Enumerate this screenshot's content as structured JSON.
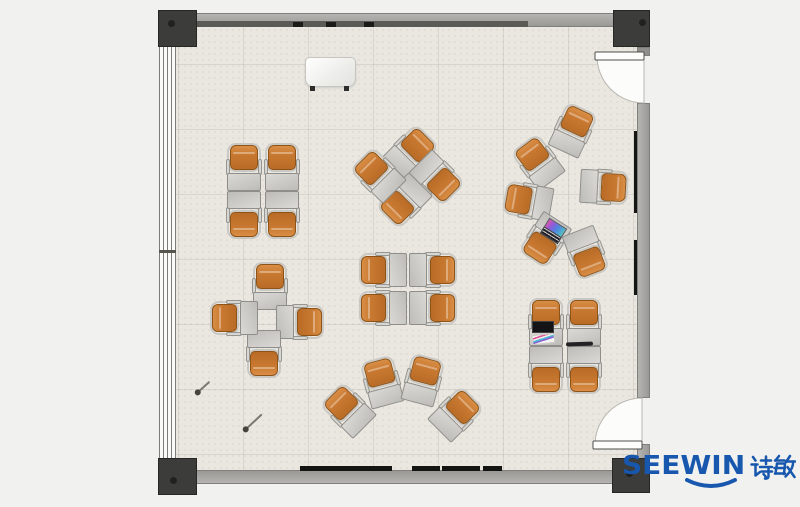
{
  "brand": {
    "name": "SEEWIN",
    "chinese": "诗敏",
    "color": "#1857ae"
  },
  "palette": {
    "floor": "#eae7e0",
    "wall": "#a6a5a1",
    "column": "#3c3c3a",
    "chair": "#c4752e",
    "desk": "#cbcac6",
    "frame": "#c9c8c4",
    "door_swing": "#fcfcfa"
  },
  "room": {
    "columns": [
      {
        "x": 158,
        "y": 10,
        "w": 39,
        "h": 37,
        "dx": 9,
        "dy": 9
      },
      {
        "x": 613,
        "y": 10,
        "w": 37,
        "h": 37,
        "dx": 25,
        "dy": 8
      },
      {
        "x": 158,
        "y": 458,
        "w": 39,
        "h": 37,
        "dx": 11,
        "dy": 18
      },
      {
        "x": 612,
        "y": 458,
        "w": 38,
        "h": 35,
        "dx": 13,
        "dy": 11
      }
    ],
    "doors": [
      {
        "id": "door-top-right",
        "leaf": [
          595,
          52,
          49,
          8
        ],
        "region": "M644 56 L597 56 A47 47 0 0 0 644 103 Z"
      },
      {
        "id": "door-bottom-right",
        "leaf": [
          593,
          441,
          49,
          8
        ],
        "region": "M642 445 L595 445 A47 47 0 0 1 642 398 Z"
      }
    ],
    "wall_ticks_x": [
      293,
      326,
      364
    ],
    "rails": [
      [
        300,
        92
      ],
      [
        412,
        28
      ],
      [
        442,
        38
      ],
      [
        483,
        19
      ]
    ],
    "right_wall_strips": [
      [
        131,
        82
      ],
      [
        240,
        55
      ]
    ]
  },
  "furniture": {
    "unit_style": {
      "chair": "#c4752e",
      "chair_border": "#8d5317",
      "desk": "#cbcac6",
      "desk_border": "#8f8e8a",
      "frame": "#c9c8c4"
    },
    "clusters": [
      {
        "id": "front-left-grid",
        "units": [
          {
            "x": 244,
            "y": 167,
            "r": 0
          },
          {
            "x": 282,
            "y": 167,
            "r": 0
          },
          {
            "x": 244,
            "y": 215,
            "r": 180
          },
          {
            "x": 282,
            "y": 215,
            "r": 180
          }
        ]
      },
      {
        "id": "front-center-diamond",
        "units": [
          {
            "x": 411,
            "y": 152,
            "r": 45
          },
          {
            "x": 437,
            "y": 178,
            "r": 135
          },
          {
            "x": 404,
            "y": 201,
            "r": 225
          },
          {
            "x": 378,
            "y": 175,
            "r": 315
          }
        ]
      },
      {
        "id": "right-circle",
        "units": [
          {
            "x": 573,
            "y": 130,
            "r": 25
          },
          {
            "x": 538,
            "y": 162,
            "r": 323
          },
          {
            "x": 528,
            "y": 201,
            "r": 280
          },
          {
            "x": 604,
            "y": 187,
            "r": 93
          },
          {
            "x": 545,
            "y": 240,
            "r": 213
          },
          {
            "x": 586,
            "y": 253,
            "r": 159
          }
        ]
      },
      {
        "id": "mid-left-pinwheel",
        "units": [
          {
            "x": 270,
            "y": 286,
            "r": 0
          },
          {
            "x": 300,
            "y": 322,
            "r": 90
          },
          {
            "x": 264,
            "y": 354,
            "r": 180
          },
          {
            "x": 234,
            "y": 318,
            "r": 270
          }
        ]
      },
      {
        "id": "center-grid",
        "units": [
          {
            "x": 383,
            "y": 270,
            "r": 270
          },
          {
            "x": 433,
            "y": 270,
            "r": 90
          },
          {
            "x": 383,
            "y": 308,
            "r": 270
          },
          {
            "x": 433,
            "y": 308,
            "r": 90
          }
        ]
      },
      {
        "id": "bottom-fan",
        "units": [
          {
            "x": 348,
            "y": 410,
            "r": 315
          },
          {
            "x": 382,
            "y": 382,
            "r": 345
          },
          {
            "x": 423,
            "y": 380,
            "r": 15
          },
          {
            "x": 456,
            "y": 414,
            "r": 45
          }
        ]
      },
      {
        "id": "bottom-right-grid",
        "units": [
          {
            "x": 546,
            "y": 322,
            "r": 0
          },
          {
            "x": 584,
            "y": 322,
            "r": 0
          },
          {
            "x": 546,
            "y": 370,
            "r": 180
          },
          {
            "x": 584,
            "y": 370,
            "r": 180
          }
        ]
      }
    ],
    "items": [
      {
        "type": "podium",
        "x": 305,
        "y": 57,
        "r": 0
      },
      {
        "type": "laptop-rainbow",
        "x": 543,
        "y": 222,
        "r": 32
      },
      {
        "type": "laptop-black",
        "x": 532,
        "y": 321,
        "r": 0
      },
      {
        "type": "ruler",
        "x": 566,
        "y": 342,
        "r": -2
      },
      {
        "type": "stick",
        "x": 197,
        "y": 392,
        "len": 17,
        "r": -42
      },
      {
        "type": "stick",
        "x": 245,
        "y": 429,
        "len": 23,
        "r": -43
      }
    ]
  }
}
